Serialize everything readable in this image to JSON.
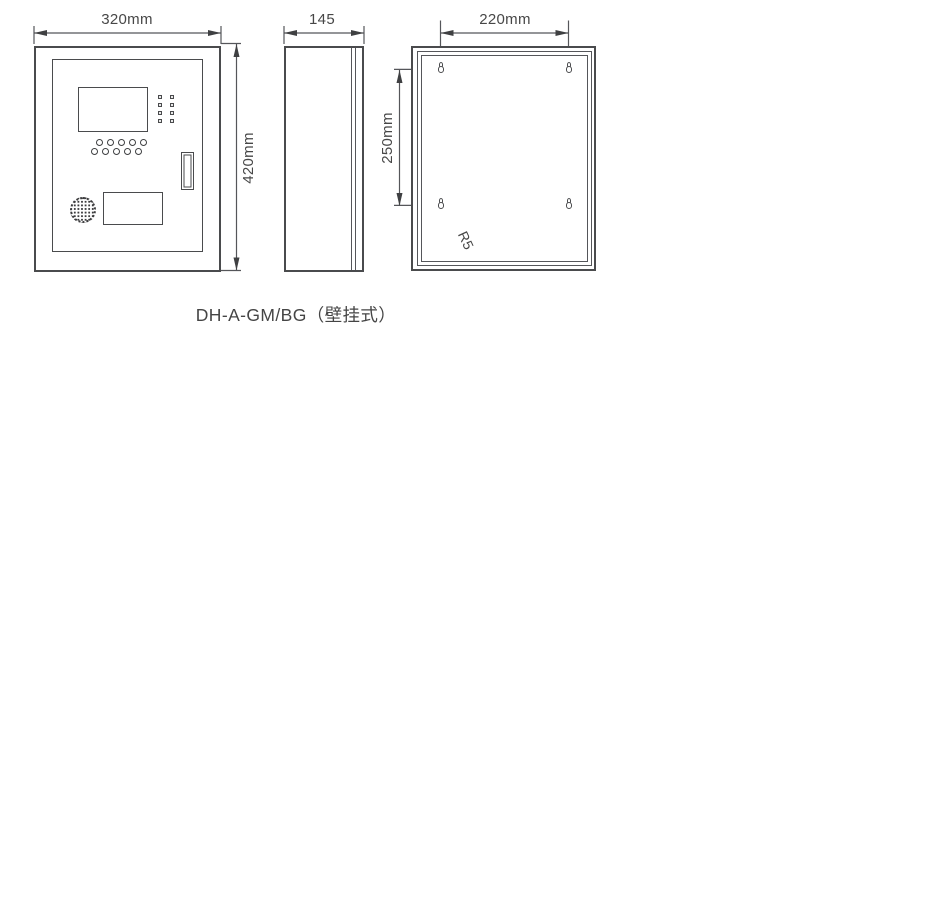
{
  "page": {
    "title": "DH-A-GM/BG（壁挂式）"
  },
  "colors": {
    "line": "#4a4b4d",
    "text": "#454545",
    "background": "#ffffff"
  },
  "views": {
    "front": {
      "width_dim": "320mm",
      "height_dim": "420mm"
    },
    "side": {
      "depth_dim": "145"
    },
    "back": {
      "hole_h_spacing_dim": "220mm",
      "hole_v_spacing_dim": "250mm",
      "hole_radius_callout": "R5"
    }
  }
}
